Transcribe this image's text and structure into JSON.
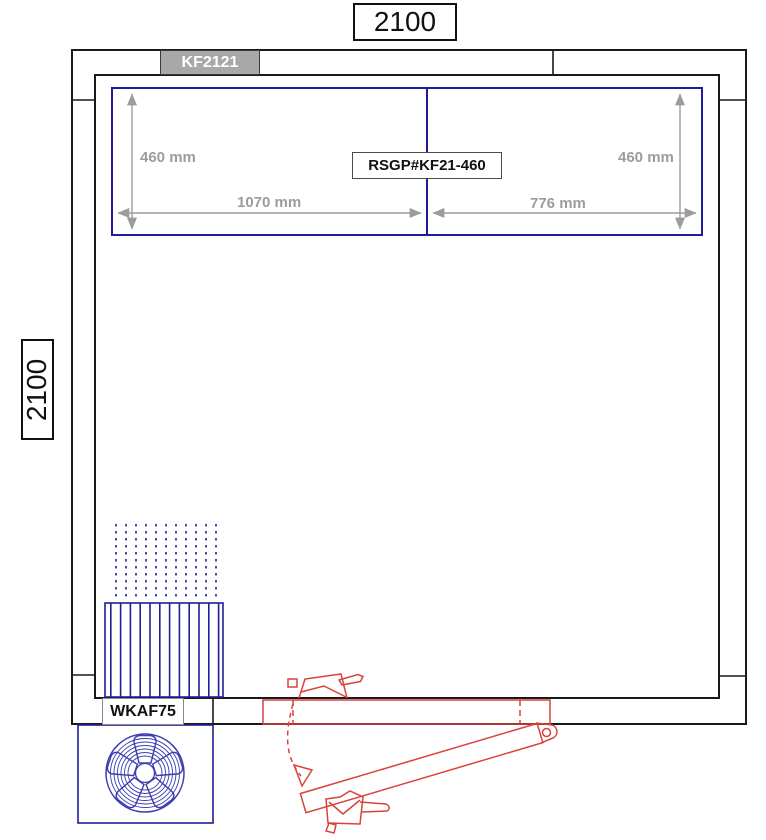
{
  "colors": {
    "ink": "#1a1a1a",
    "blue": "#1e1e98",
    "fanblue": "#3c3cae",
    "red": "#d9423a",
    "dim": "#9c9c9c",
    "panelgray": "#a8a8a8"
  },
  "dims": {
    "width": "2100",
    "height": "2100"
  },
  "labels": {
    "panel": "KF2121",
    "shelf": "RSGP#KF21-460",
    "condensing_unit": "WKAF75"
  },
  "shelf_dims": {
    "left_depth": "460 mm",
    "right_depth": "460 mm",
    "left_width": "1070 mm",
    "right_width": "776 mm"
  }
}
